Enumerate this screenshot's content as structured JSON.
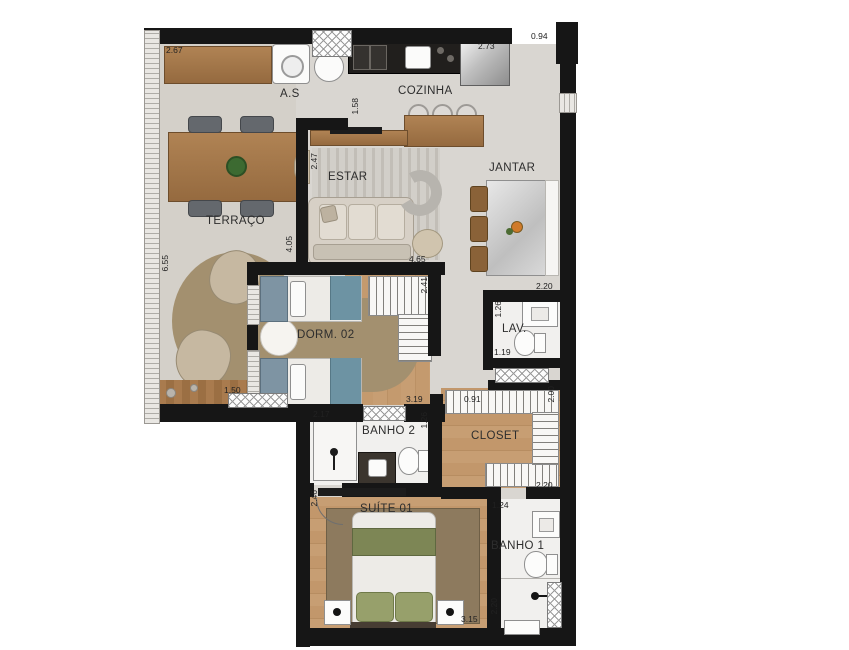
{
  "rooms": {
    "terraco": "TERRAÇO",
    "as": "A.S",
    "cozinha": "COZINHA",
    "estar": "ESTAR",
    "jantar": "JANTAR",
    "dorm02": "DORM. 02",
    "lav": "LAV.",
    "banho2": "BANHO 2",
    "closet": "CLOSET",
    "suite01": "SUÍTE 01",
    "banho1": "BANHO 1"
  },
  "dims": {
    "terraco_top": "2.67",
    "terraco_side": "6.55",
    "terraco_door": "1.50",
    "kitchen_top": "2.73",
    "entry": "0.94",
    "estar_wall": "1.58",
    "estar_side": "2.47",
    "terraco_estar": "4.05",
    "estar_bottom": "4.65",
    "dorm_side": "2.41",
    "jantar_bottom": "2.20",
    "lav_side": "1.26",
    "lav_bottom": "1.19",
    "closet_side": "2.00",
    "hall": "0.91",
    "dorm_bottom": "3.19",
    "banho2_top": "2.17",
    "banho2_side": "1.26",
    "closet_bottom": "2.20",
    "suite_side": "2.46",
    "banho1_top": "1.24",
    "banho1_side": "2.20",
    "suite_bottom": "3.15"
  },
  "colors": {
    "wall": "#161616",
    "floor": "#d9d6d1",
    "wood_furniture": "#a5794d",
    "wood_floor": "#c79e73",
    "teal_accent": "#6d93a3",
    "olive_accent": "#7d8655",
    "rug": "#a3906f",
    "tile": "#f1f0ee"
  }
}
